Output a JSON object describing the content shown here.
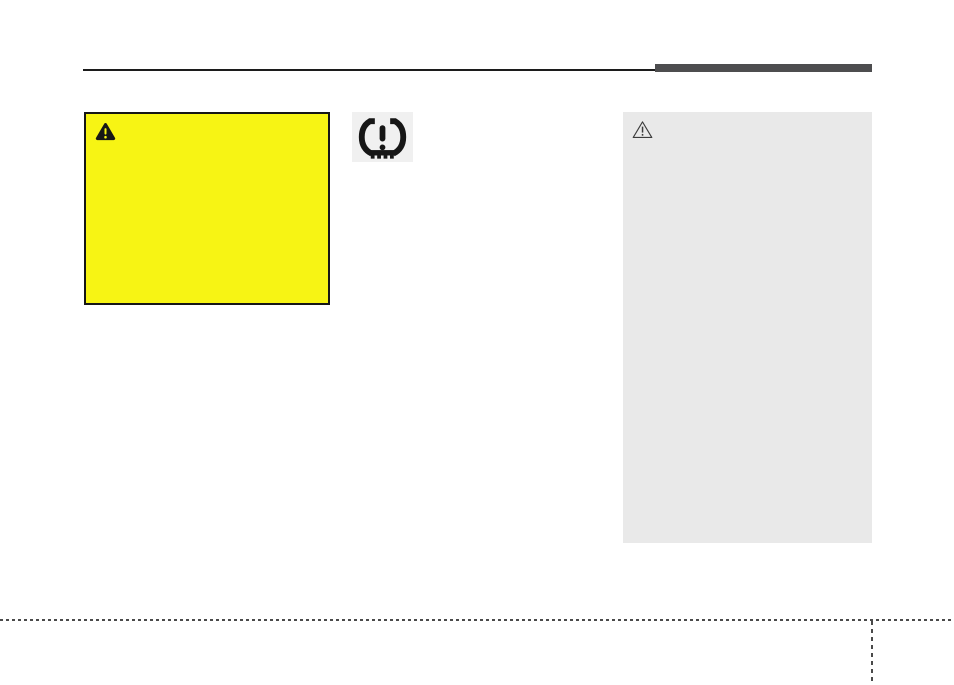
{
  "page": {
    "type": "owners-manual-page",
    "background": "#ffffff"
  },
  "header": {
    "rule_color": "#1c1c1c",
    "accent_bar_color": "#4d4d4f"
  },
  "warning_callout": {
    "fill": "#f7f414",
    "border_color": "#161616",
    "icon": "warning-triangle-icon",
    "icon_fill": "#161616",
    "icon_glyph_color": "#f7f414"
  },
  "tpms_indicator": {
    "icon": "tpms-low-tire-pressure-icon",
    "background": "#f0f0f0",
    "symbol_color": "#161616"
  },
  "caution_callout": {
    "fill": "#e9e9e9",
    "icon": "caution-triangle-outline-icon",
    "icon_stroke": "#3c3c3c"
  },
  "footer": {
    "dashed_rule_color": "#4a4a4a"
  }
}
